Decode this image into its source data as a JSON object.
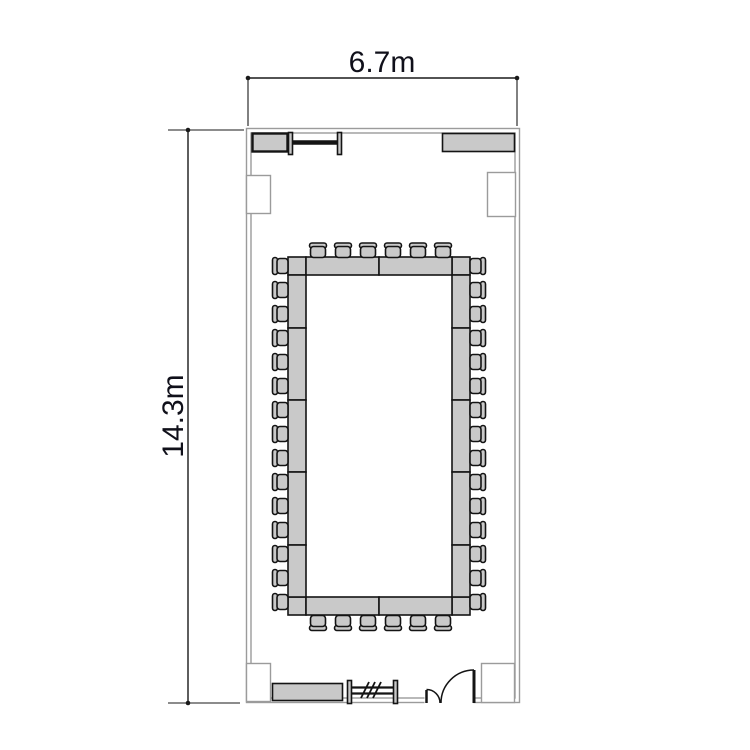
{
  "dimensions": {
    "width_label": "6.7m",
    "height_label": "14.3m"
  },
  "plan": {
    "type": "meeting-room-floor-plan",
    "layout_style": "hollow-rectangle-boardroom",
    "colors": {
      "background": "#ffffff",
      "wall_line": "#9b9b9b",
      "furniture_fill": "#c9c9c9",
      "furniture_stroke": "#141414",
      "dimension_line": "#1a1a1a",
      "label_text": "#10101a"
    },
    "chairs": {
      "top": 6,
      "bottom": 6,
      "left": 15,
      "right": 15,
      "total": 42
    },
    "table": {
      "segments_short_side": 2,
      "segments_long_side": 5,
      "corner_units": 4
    },
    "furniture": [
      "credenza-top-left",
      "screen-top",
      "credenza-top-right",
      "credenza-bottom-left",
      "radiator-bottom",
      "double-door-bottom-right"
    ]
  }
}
